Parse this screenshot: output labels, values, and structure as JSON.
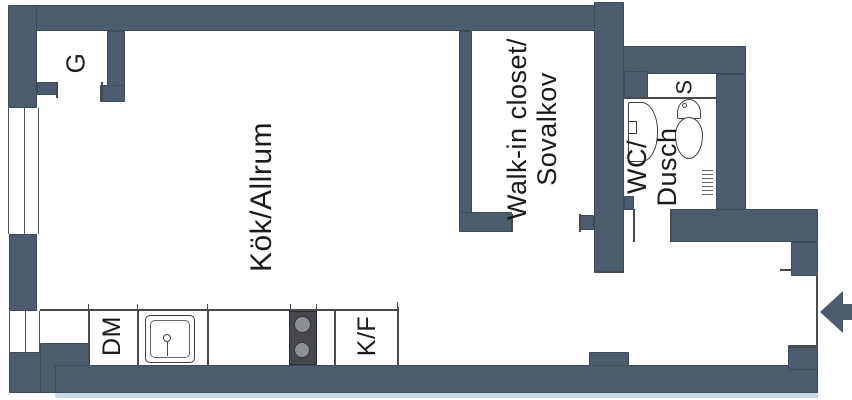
{
  "type": "floor-plan",
  "colors": {
    "background": "#ffffff",
    "wall": "#4c5b6d",
    "line": "#4a4a4a",
    "text": "#1b1b1b",
    "fixture_outline": "#3f3f3f",
    "stove_body": "#46484e",
    "stove_burner": "#8d9196",
    "bottom_strip": "#ccd9e6"
  },
  "rooms": {
    "kitchen_living": {
      "label": "Kök/Allrum"
    },
    "walk_in_closet": {
      "label_line1": "Walk-in closet/",
      "label_line2": "Sovalkov"
    },
    "wc_shower": {
      "label_line1": "WC/",
      "label_line2": "Dusch"
    },
    "wardrobe": {
      "label": "G"
    },
    "shaft": {
      "label": "S"
    }
  },
  "kitchen_units": {
    "dishwasher": "DM",
    "fridge_freezer": "K/F"
  },
  "fixtures": [
    "kitchen-sink",
    "stove-2-burners",
    "wc-sink",
    "toilet"
  ],
  "entry": {
    "arrow_direction": "left"
  }
}
